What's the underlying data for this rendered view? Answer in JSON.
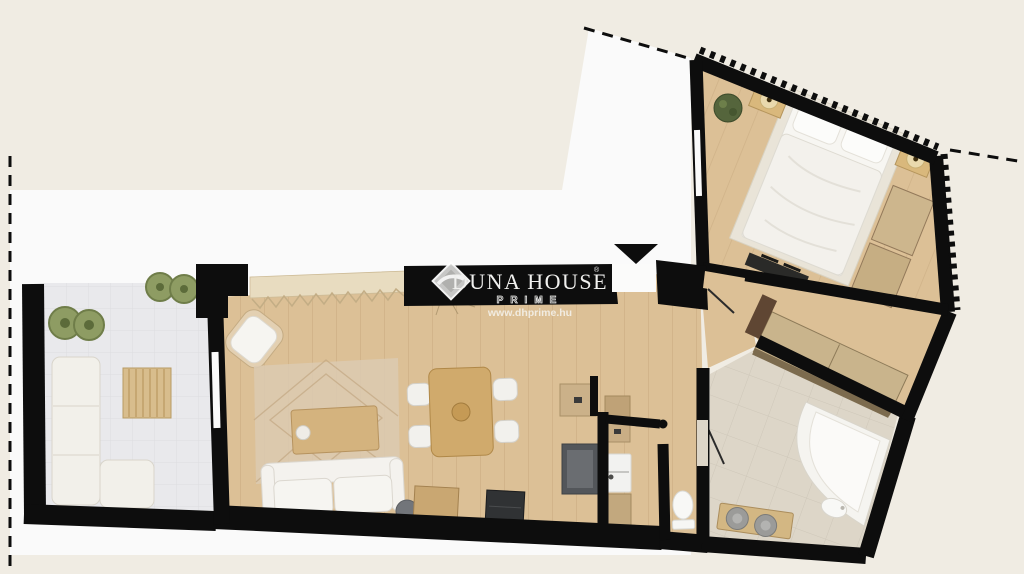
{
  "watermark": {
    "brand": "DUNA HOUSE",
    "registered": "®",
    "tier": "PRIME",
    "website": "www.dhprime.hu"
  },
  "icons": {
    "entrance_arrow": "triangle-down",
    "brand_logo": "diamond-swoosh"
  },
  "colors": {
    "background": "#f0ece3",
    "plot": "#fafafa",
    "wall": "#0d0d0d",
    "wood_floor": "#dcc096",
    "terrace_tile": "#e9e9ec",
    "bath_tile": "#ddd6c8",
    "closet_wood": "#c9b48c",
    "furniture_wood": "#d0aa6c",
    "white_furniture": "#f5f4f0",
    "plant": "#8e9c63",
    "dark_accent": "#53565a"
  }
}
